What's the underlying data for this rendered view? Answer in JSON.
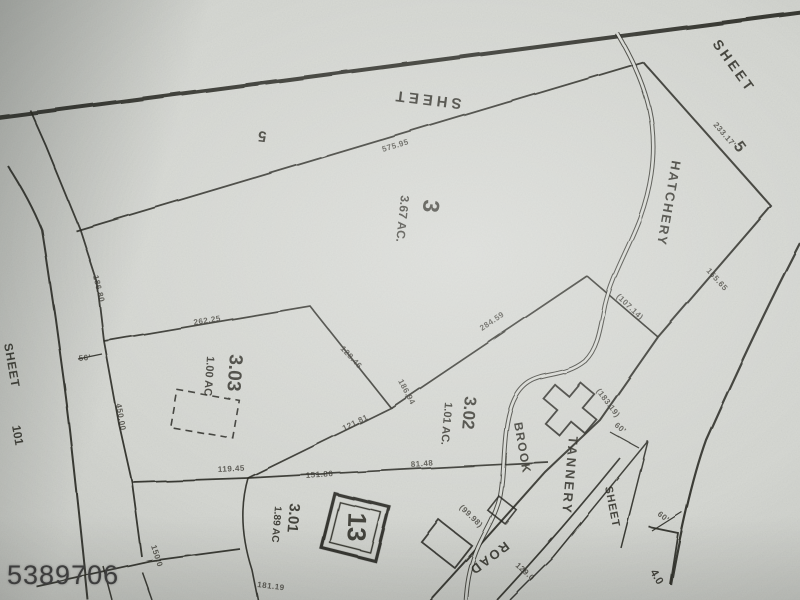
{
  "photo": {
    "watermark_id": "5389706"
  },
  "map": {
    "block_number": "13",
    "parcels": [
      {
        "id": "3",
        "area": "3.67 AC."
      },
      {
        "id": "3.03",
        "area": "1.00 AC"
      },
      {
        "id": "3.02",
        "area": "1.01 AC."
      },
      {
        "id": "3.01",
        "area": "1.89 AC"
      }
    ],
    "roads": {
      "name_line1": "TANNERY",
      "name_line2": "ROAD"
    },
    "stream": {
      "name_line1": "HATCHERY",
      "name_line2": "BROOK"
    },
    "sheet_references": {
      "top": {
        "label": "SHEET",
        "number": "5"
      },
      "right": {
        "label": "SHEET",
        "number": "5"
      },
      "left": {
        "label": "SHEET",
        "number": "101"
      },
      "bottom_right": {
        "label": "SHEET",
        "number": "4.0"
      }
    },
    "dimensions": [
      {
        "text": "575.95",
        "x": 383,
        "y": 152,
        "rot": -17
      },
      {
        "text": "233.17'",
        "x": 713,
        "y": 125,
        "rot": 49
      },
      {
        "text": "165.65",
        "x": 706,
        "y": 271,
        "rot": 48
      },
      {
        "text": "(107.14)",
        "x": 616,
        "y": 297,
        "rot": 44
      },
      {
        "text": "(183.19)",
        "x": 596,
        "y": 391,
        "rot": 53
      },
      {
        "text": "284.59",
        "x": 482,
        "y": 331,
        "rot": -34
      },
      {
        "text": "186.94",
        "x": 398,
        "y": 381,
        "rot": 62
      },
      {
        "text": "128.46",
        "x": 340,
        "y": 349,
        "rot": 47
      },
      {
        "text": "262.25",
        "x": 194,
        "y": 325,
        "rot": -9
      },
      {
        "text": "186.80",
        "x": 93,
        "y": 276,
        "rot": 76
      },
      {
        "text": "450.00",
        "x": 116,
        "y": 404,
        "rot": 80
      },
      {
        "text": "119.45",
        "x": 218,
        "y": 472,
        "rot": -3
      },
      {
        "text": "151.86",
        "x": 306,
        "y": 478,
        "rot": -4
      },
      {
        "text": "81.48",
        "x": 411,
        "y": 467,
        "rot": -4
      },
      {
        "text": "121.81",
        "x": 344,
        "y": 431,
        "rot": -26
      },
      {
        "text": "60'",
        "x": 614,
        "y": 426,
        "rot": 40
      },
      {
        "text": "60'",
        "x": 657,
        "y": 515,
        "rot": 38
      },
      {
        "text": "(99.98)",
        "x": 459,
        "y": 508,
        "rot": 44
      },
      {
        "text": "129.0",
        "x": 515,
        "y": 566,
        "rot": 42
      },
      {
        "text": "181.19",
        "x": 257,
        "y": 587,
        "rot": 7
      },
      {
        "text": "150.0",
        "x": 151,
        "y": 546,
        "rot": 72
      },
      {
        "text": "56'",
        "x": 79,
        "y": 361,
        "rot": -6
      }
    ]
  }
}
